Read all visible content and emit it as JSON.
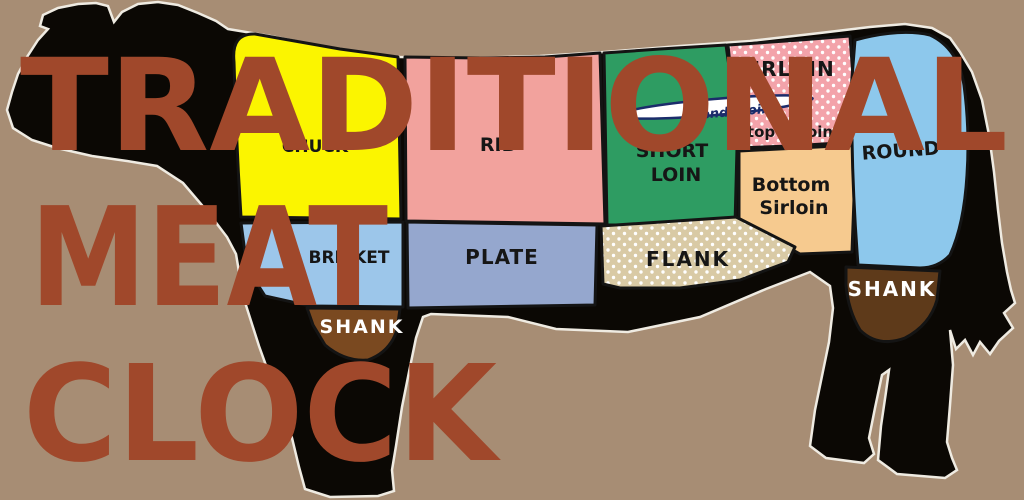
{
  "title": {
    "line1": "TRADITIONAL",
    "line2": "MEAT",
    "line3": "CLOCK",
    "color": "#A0482B"
  },
  "canvas": {
    "background": "#A78D74",
    "silhouette": "#0B0804"
  },
  "cuts": {
    "chuck": {
      "label": "CHUCK",
      "color": "#FBF500"
    },
    "rib": {
      "label": "RIB",
      "color": "#F2A29D"
    },
    "short_loin": {
      "line1": "SHORT",
      "line2": "LOIN",
      "color": "#2E9C62"
    },
    "sirloin": {
      "label": "SIRLOIN",
      "color": "#F3A3AA",
      "dot_color": "#FFFFFF"
    },
    "tenderloin": {
      "label": "tenderloin",
      "color": "#FFFFFF",
      "stroke": "#1B2C6B"
    },
    "top_sirloin": {
      "label": "top sirloin"
    },
    "bottom_sirloin": {
      "line1": "Bottom",
      "line2": "Sirloin",
      "color": "#F6CA8F"
    },
    "round": {
      "label": "ROUND",
      "color": "#8DC8EC"
    },
    "brisket": {
      "label": "BRISKET",
      "color": "#9CC6EA"
    },
    "plate": {
      "label": "PLATE",
      "color": "#95A7CE"
    },
    "flank": {
      "label": "FLANK",
      "color": "#D9CAA5",
      "dot_color": "#FFFFFF"
    },
    "shank_front": {
      "label": "SHANK",
      "color": "#7A4920",
      "text_color": "#FFFFFF"
    },
    "shank_rear": {
      "label": "SHANK",
      "color": "#5E3A1A",
      "text_color": "#FFFFFF"
    }
  }
}
